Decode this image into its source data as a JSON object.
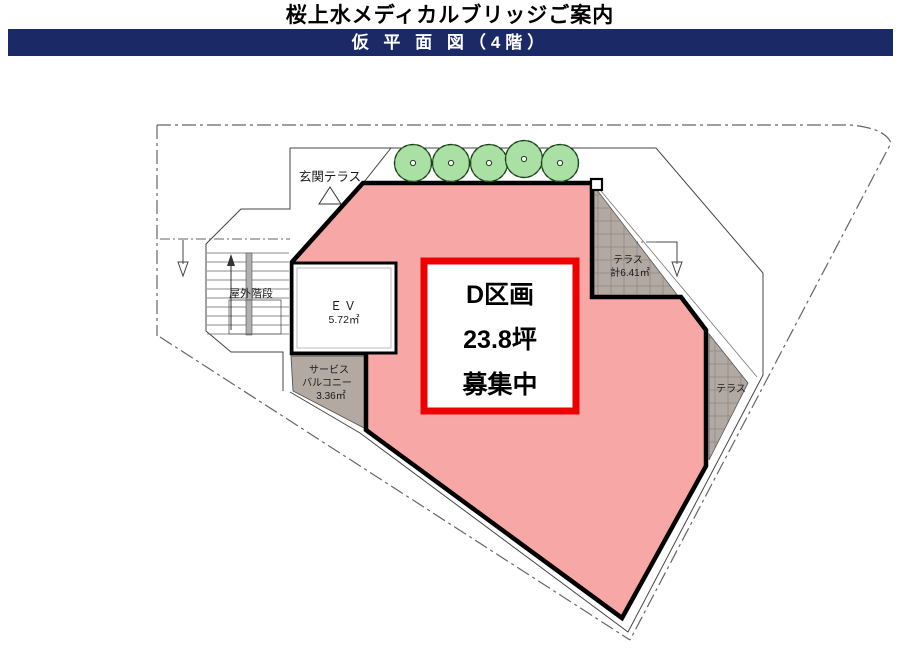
{
  "header": {
    "title": "桜上水メディカルブリッジご案内",
    "banner": "仮 平 面 図（4階）"
  },
  "plan": {
    "unit": {
      "name": "D区画",
      "size": "23.8坪",
      "status": "募集中"
    },
    "labels": {
      "entrance_terrace": "玄関テラス",
      "outdoor_stairs": "屋外階段",
      "elevator": "ＥＶ",
      "elevator_area": "5.72㎡",
      "service_balcony_line1": "サービス",
      "service_balcony_line2": "バルコニー",
      "service_balcony_area": "3.36㎡",
      "terrace_upper": "テラス",
      "terrace_upper_area": "計6.41㎡",
      "terrace_lower": "テラス"
    },
    "colors": {
      "banner_bg": "#1b2a66",
      "banner_fg": "#ffffff",
      "unit_fill": "#f8a7a7",
      "unit_border": "#000000",
      "highlight_border": "#ee0000",
      "terrace_fill": "#b3a9a3",
      "tree_fill": "#abe0a4",
      "tree_stroke": "#2b5d2b",
      "outline": "#444444",
      "boundary": "#666666"
    }
  }
}
